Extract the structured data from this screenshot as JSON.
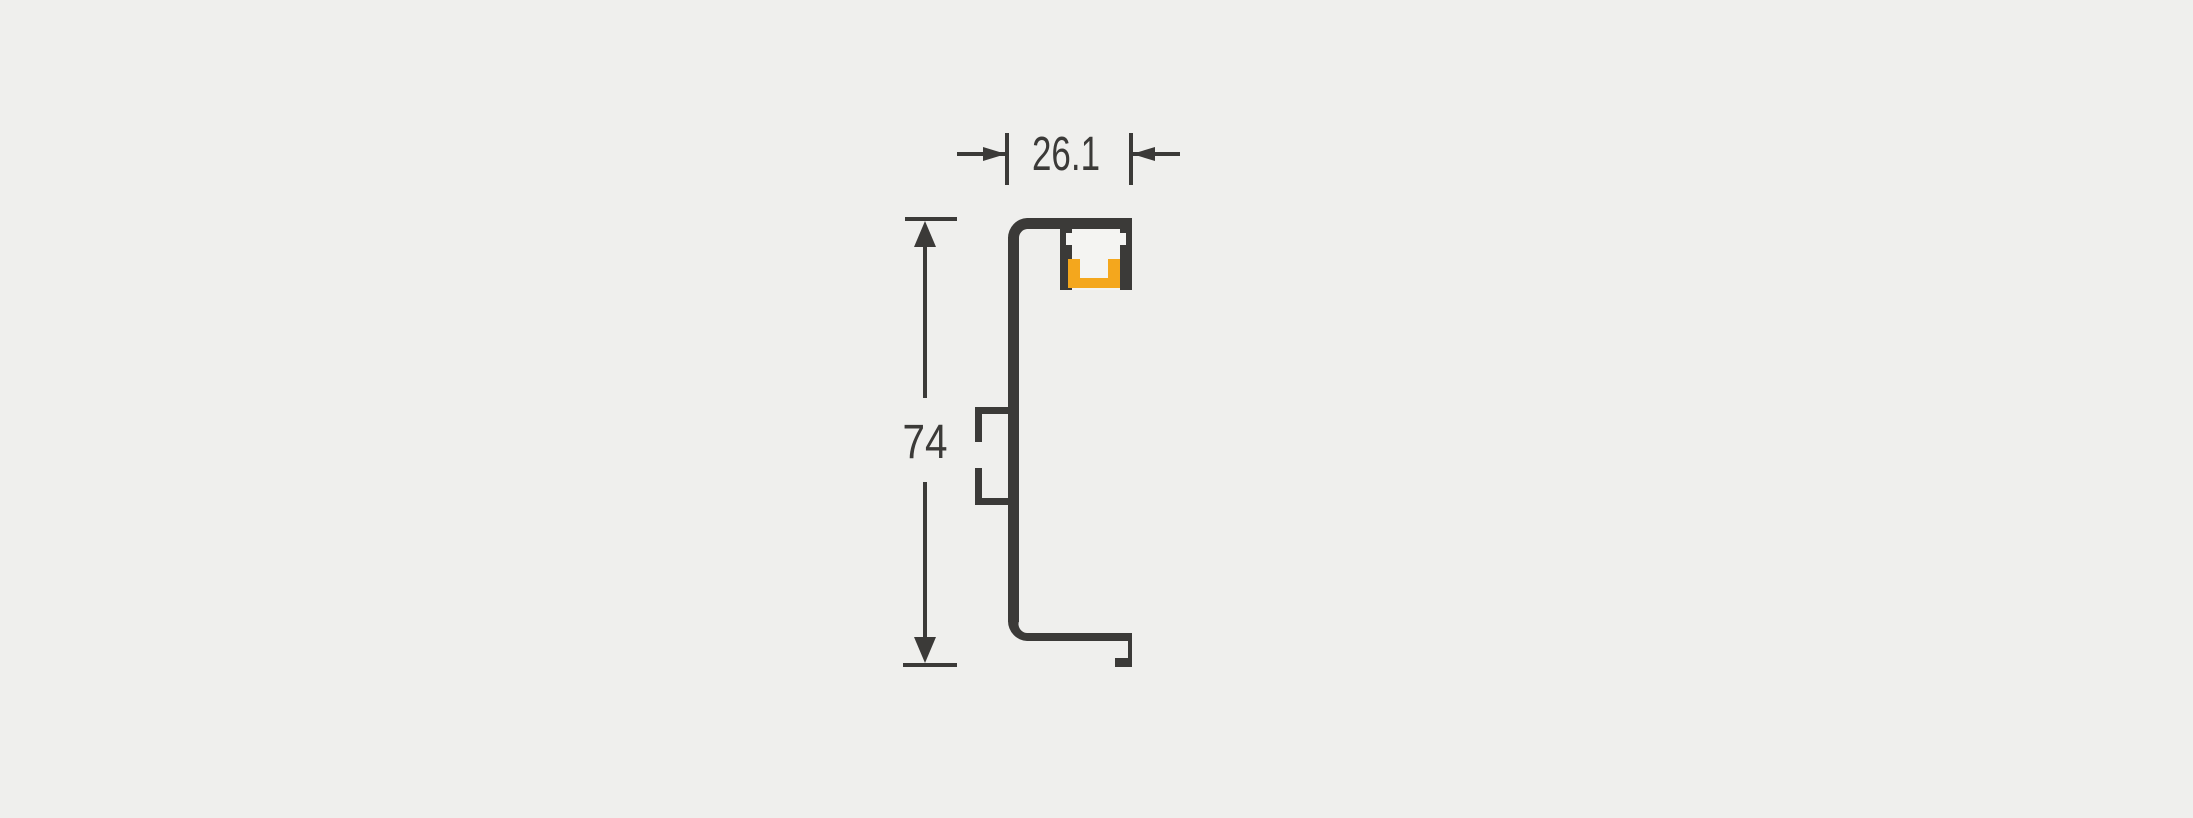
{
  "colors": {
    "background": "#EFEFED",
    "profile": "#3B3A38",
    "led": "#F4A71D",
    "interior": "#F4F4F2",
    "dimension": "#3B3A38"
  },
  "drawing": {
    "dimensions": {
      "width": "26.1",
      "height": "74"
    }
  }
}
